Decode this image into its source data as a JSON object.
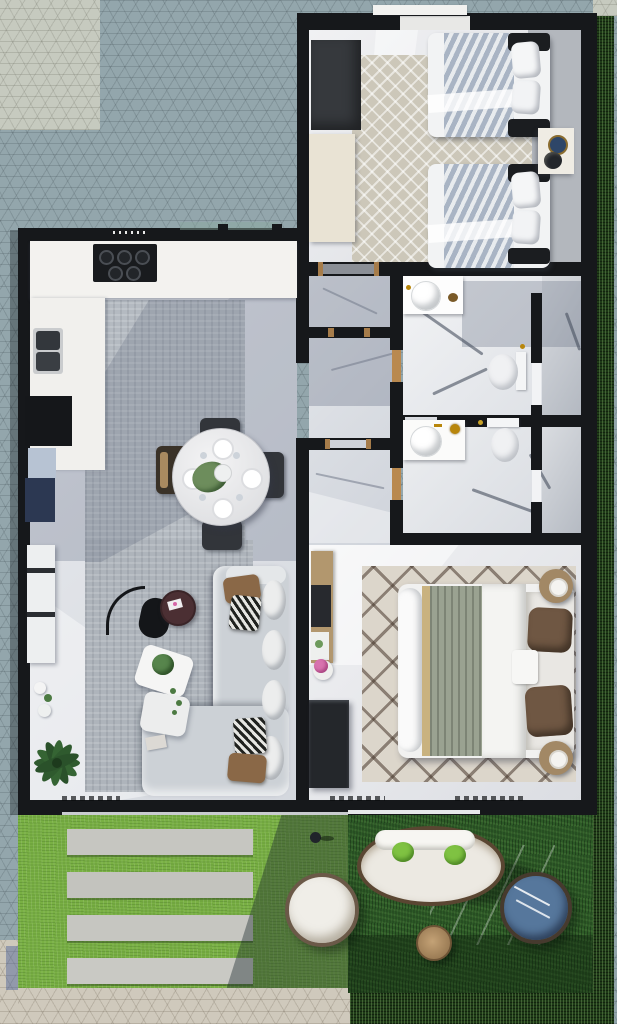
{
  "meta": {
    "type": "3d-floor-plan-render",
    "view": "top-down",
    "width_px": 617,
    "height_px": 1024
  },
  "palette": {
    "exterior_stone_blue": "#93a6ac",
    "exterior_stone_light": "#c6cabf",
    "exterior_stone_warm": "#cfc9bc",
    "wall_black": "#16181b",
    "marble_floor": "#e7e8eb",
    "marble_shadow": "#9aa3b5",
    "bathroom_marble": "#c9cdd3",
    "lawn_green": "#79b044",
    "garden_grass_dark": "#2d5a27",
    "hedge_green": "#1e3a17",
    "paver_gray": "#c6c6c1",
    "rug_diamond_beige": "#ccc7b9",
    "rug_gray": "#b4bac1",
    "rug_berber": "#dcd6cb",
    "sofa_gray": "#ccd1d6",
    "bed_white": "#f2f3f4",
    "duvet_stripe_blue": "#a9b4c4",
    "blanket_sage": "#9aa291",
    "pillow_brown": "#8a6847",
    "wood_tan": "#b2976e",
    "navy_cabinet": "#2c3852",
    "coffee_table_maroon": "#4b2f33",
    "outdoor_pillow_green": "#7fc242",
    "gold_fixture": "#b8860b",
    "window_blue": "#b7c3d3"
  },
  "scene": {
    "rooms": [
      {
        "id": "twin-bedroom",
        "furniture": [
          "wardrobe",
          "dresser",
          "diamond-rug",
          "twin-bed-top",
          "twin-bed-bottom",
          "nightstand",
          "window"
        ]
      },
      {
        "id": "bathroom-1",
        "furniture": [
          "vanity-sink",
          "toilet",
          "shower-compartment"
        ]
      },
      {
        "id": "bathroom-2",
        "furniture": [
          "vanity-sink",
          "toilet",
          "shower-compartment"
        ]
      },
      {
        "id": "hallway",
        "furniture": [
          "door-thresholds"
        ]
      },
      {
        "id": "kitchen",
        "furniture": [
          "counter",
          "gas-cooktop",
          "double-sink",
          "refrigerator",
          "window",
          "navy-cabinet"
        ]
      },
      {
        "id": "dining-area",
        "furniture": [
          "round-marble-table",
          "chair-north",
          "chair-east",
          "chair-south",
          "chair-west",
          "area-rug",
          "place-settings",
          "centerpiece-plant"
        ]
      },
      {
        "id": "living-room",
        "furniture": [
          "l-shaped-sofa",
          "arc-floor-lamp",
          "round-coffee-table",
          "nesting-side-tables",
          "potted-palm",
          "media-bench",
          "throw-pillows",
          "vases"
        ]
      },
      {
        "id": "master-bedroom",
        "furniture": [
          "double-bed",
          "berber-rug",
          "nightstand-top",
          "nightstand-bottom",
          "desk",
          "dresser",
          "flower-stool"
        ]
      },
      {
        "id": "garden",
        "furniture": [
          "lawn",
          "paver-1",
          "paver-2",
          "paver-3",
          "paver-4",
          "oval-daybed",
          "round-chair-white",
          "round-chair-blue",
          "wood-stool",
          "bottle",
          "hedge-right",
          "hedge-bottom"
        ]
      }
    ],
    "counts": {
      "twin_beds": 2,
      "bathrooms": 2,
      "lawn_pavers": 4,
      "dining_chairs": 4,
      "garden_lounge_chairs": 2,
      "green_outdoor_pillows": 2
    }
  }
}
